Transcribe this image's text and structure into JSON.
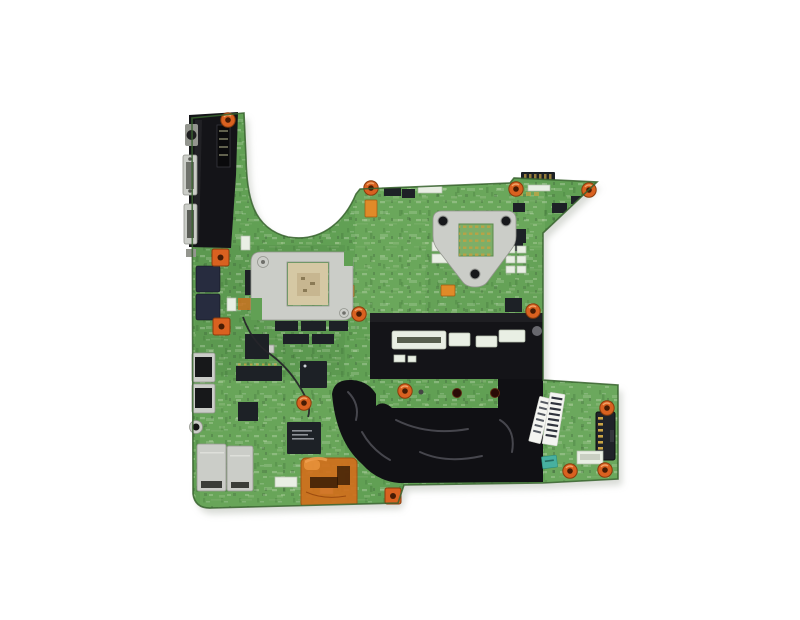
{
  "image": {
    "title": "Laptop motherboard product photo",
    "description": "Top-down product photo of a green laptop motherboard on a plain white background. Large areas are covered by black protective tape and wrinkled black film. A silver CPU socket retention bracket sits upper right, a silver GPU retention frame with an exposed tan package sits left of center, black tape covers the memory slot area, an orange kapton tape patch covers chips near the bottom, external ports line the left edge, orange screw grommets mark mounting holes, and white barcode stickers plus a small teal QC sticker sit near the bottom right beside the battery connector."
  },
  "colors": {
    "background": "#ffffff",
    "pcb": "#61a054",
    "pcb-light": "#8cc077",
    "pcb-dark": "#3f7438",
    "pcb-edge": "#38632f",
    "tape": "#141418",
    "film": "#101014",
    "film-sheen": "#8a8a92",
    "metal": "#cbcdc8",
    "metal-shadow": "#94968f",
    "screw-orange": "#d96120",
    "screw-core": "#471c05",
    "copper-tape": "#d06f1d",
    "chip": "#1d2126",
    "chip-navy": "#272c3f",
    "substrate": "#d5c8a4",
    "slot": "#e9efe4",
    "sticker": "#f4f5f1",
    "sticker-teal": "#47b0a0",
    "pin-gold": "#caa545"
  },
  "parts": [
    {
      "name": "motherboard-pcb",
      "label": "Green laptop motherboard PCB"
    },
    {
      "name": "io-area-tape",
      "label": "Black protective tape over rear I/O corner"
    },
    {
      "name": "s-video-port",
      "label": "S-Video port"
    },
    {
      "name": "vga-port",
      "label": "VGA port"
    },
    {
      "name": "expansion-port",
      "label": "Expansion connector"
    },
    {
      "name": "usb-ports",
      "label": "Stacked USB ports"
    },
    {
      "name": "audio-jack",
      "label": "Audio jack"
    },
    {
      "name": "lan-modem-shield",
      "label": "Shielded LAN / modem port cages"
    },
    {
      "name": "gpu-retention-frame",
      "label": "Silver GPU retention frame"
    },
    {
      "name": "gpu-substrate",
      "label": "Exposed GPU package substrate"
    },
    {
      "name": "cpu-retention-bracket",
      "label": "Silver CPU socket retention bracket"
    },
    {
      "name": "cpu-socket",
      "label": "CPU socket pad array"
    },
    {
      "name": "memory-slot-tape",
      "label": "Black tape band over memory slots"
    },
    {
      "name": "memory-slot-connectors",
      "label": "White memory slot connectors"
    },
    {
      "name": "protective-film",
      "label": "Wrinkled black protective film"
    },
    {
      "name": "kapton-tape-patch",
      "label": "Orange kapton tape patch over chips"
    },
    {
      "name": "southbridge-chip",
      "label": "Large BGA chipset"
    },
    {
      "name": "io-controller-chip",
      "label": "Square I/O controller chip"
    },
    {
      "name": "memory-chips",
      "label": "Rows of memory chips"
    },
    {
      "name": "battery-connector",
      "label": "Battery connector with gold pins"
    },
    {
      "name": "barcode-sticker-large",
      "label": "Large white barcode sticker"
    },
    {
      "name": "barcode-sticker-small",
      "label": "Small white barcode sticker"
    },
    {
      "name": "qc-sticker",
      "label": "Teal QC inspection sticker"
    },
    {
      "name": "screw-grommet",
      "label": "Orange screw grommet"
    },
    {
      "name": "signal-wire",
      "label": "Thin black signal wire"
    }
  ]
}
